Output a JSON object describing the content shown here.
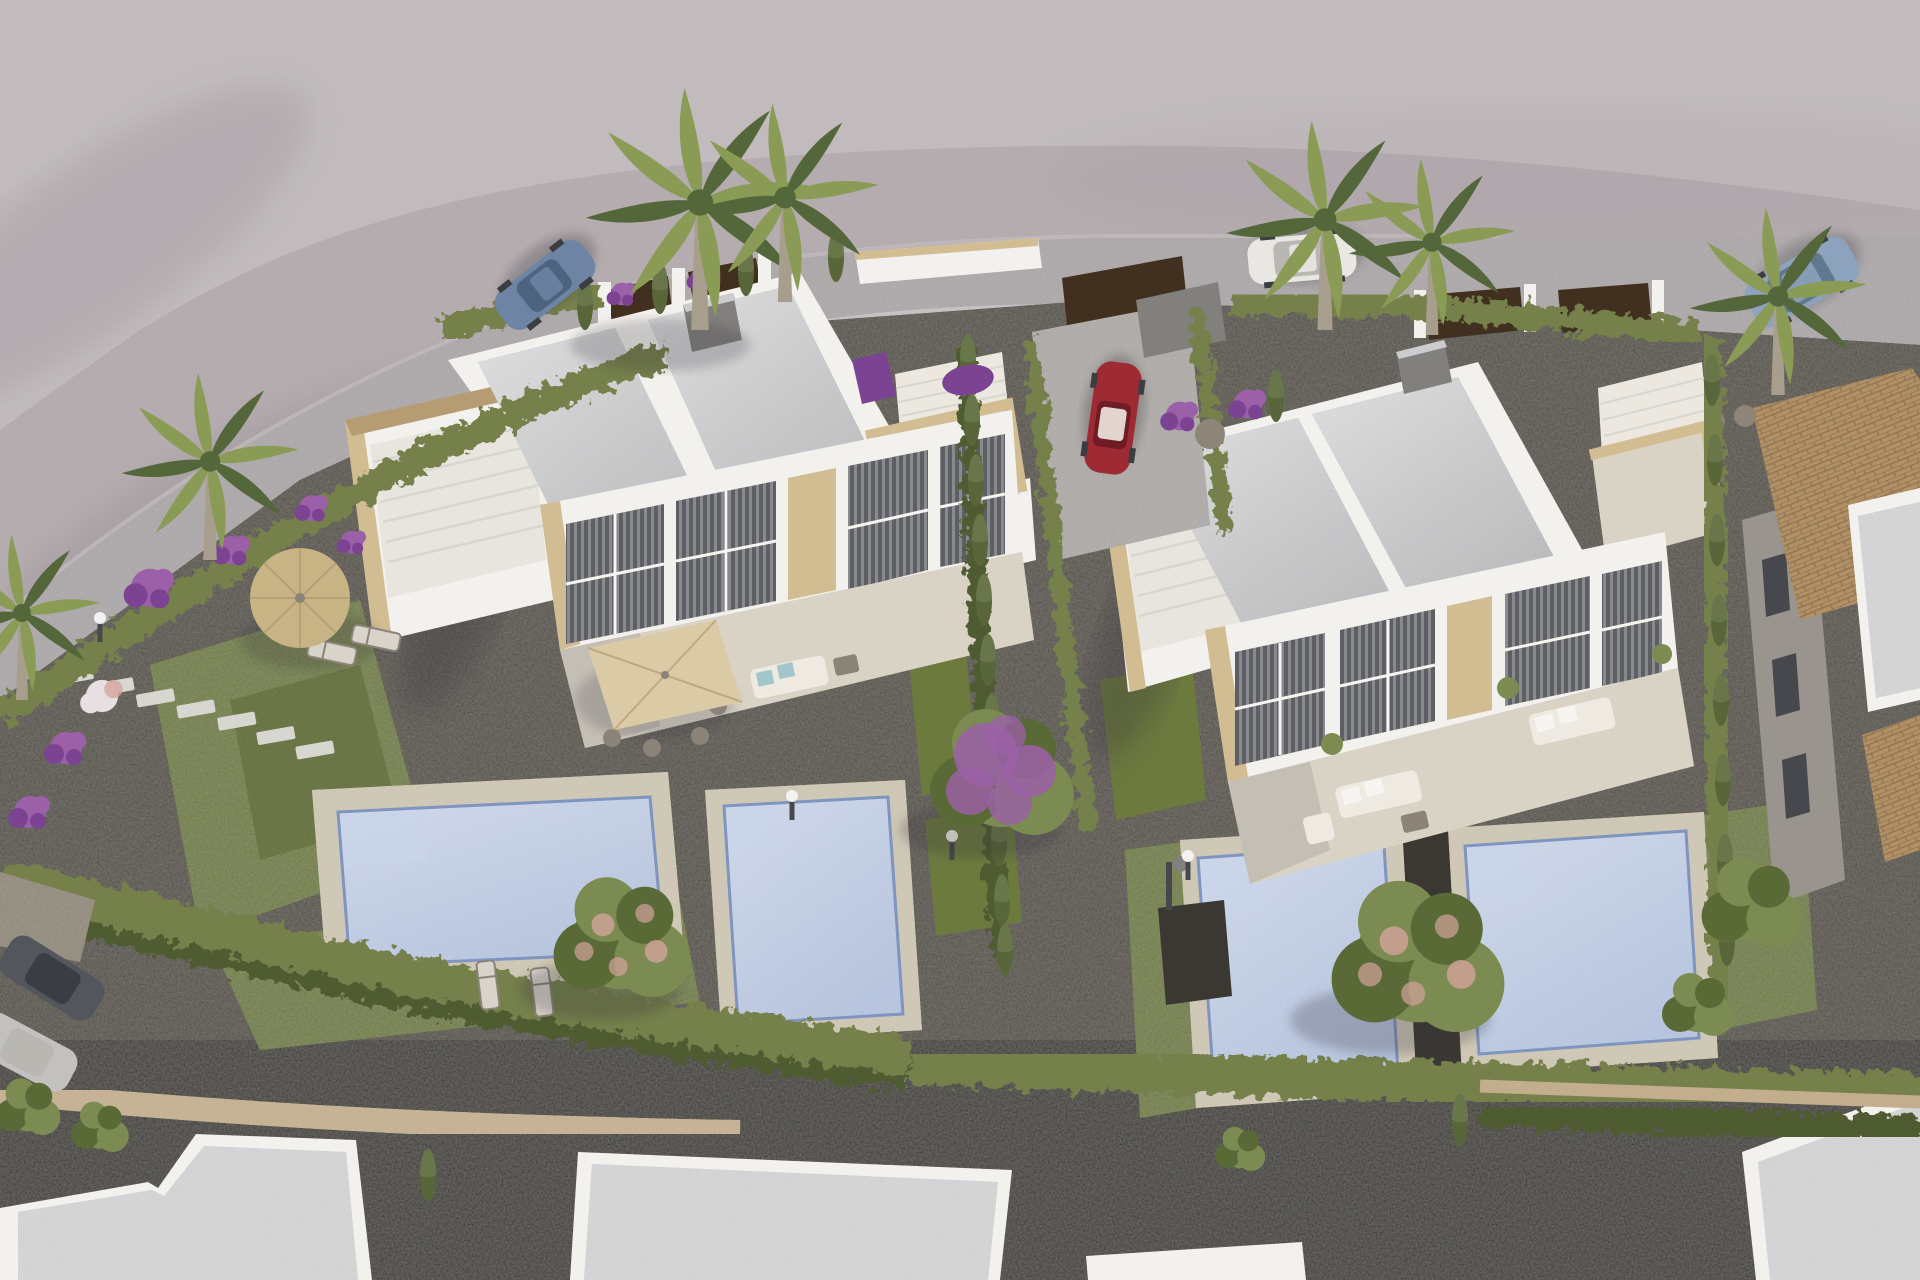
{
  "scene": {
    "type": "3d-architectural-aerial-render",
    "view": "high-angle aerial perspective",
    "setting": "New-build development of modern white semi-detached villas with flat gravel roofs, private pools, landscaped gardens, cypress hedges, palm trees and parked cars",
    "lighting": "warm late-afternoon sun from upper right, soft shadows toward lower left"
  },
  "inventory": {
    "villas": 2,
    "dwelling_units": 4,
    "pools": 4,
    "cars": 6,
    "palm_trees": 6,
    "parasols": 2,
    "neighbor_buildings": 5
  },
  "labels": {
    "ground": "Bare graded ground",
    "road": "Curved access road",
    "leftVilla": "Left semi-detached villa pair",
    "leftRoof": "Left villa gravel flat roofs",
    "leftSolarium": "Left villa roof solarium with stone parapet",
    "leftStairs": "Left villa external staircase terrace",
    "leftFacade": "Left villa glazed facade with blinds",
    "leftTerrace": "Left villa ground terrace",
    "leftGarden": "Left lawn garden with straw parasol",
    "mainPool": "Main private pool",
    "secondPool": "Second private pool",
    "rightVilla": "Right semi-detached villa pair",
    "rightRoof": "Right villa gravel flat roofs",
    "rightSolarium": "Right villa roof solarium",
    "rightStairs": "Right villa external staircase",
    "rightFacade": "Right villa glazed facade",
    "rightTerrace": "Right villa ground terrace",
    "poolC": "Right villa pool (left unit)",
    "poolD": "Right villa pool (right unit)",
    "driveway": "Shared driveway with parked red car",
    "garage": "Garage door",
    "redCar": "Red convertible in driveway",
    "sportsCar": "Blue sports car on road",
    "whiteCar": "White sedan parked on road",
    "suv": "Light blue SUV parked on road",
    "streetCars": "Cars parked on lower street",
    "palms": "Fan palm trees",
    "bougainvillea": "Purple bougainvillea tree",
    "blossomTrees": "Blossoming garden trees",
    "hedges": "Clipped boundary hedges",
    "boundaryWall": "White boundary wall with stone caps and timber gates",
    "neighborHouse": "Neighbouring house with terracotta tiled roof",
    "neighborRoofs": "Unfinished white neighbour rooftops",
    "gravel": "Dark decorative gravel",
    "steppingStones": "Stepping stone path",
    "strawParasol": "Straw parasol with loungers",
    "diningParasol": "Cream patio parasol with dining set",
    "sofas": "Outdoor lounge furniture",
    "lamps": "Garden bollard lights",
    "shower": "Outdoor pool shower",
    "flowerBeds": "Purple and white flowering shrubs",
    "stoneWall": "Stone retaining wall",
    "sandPath": "Sand-coloured footpath"
  },
  "palette": {
    "bg": "#b4acaf",
    "bgLight": "#c6c0c1",
    "bgShadow": "#9b939a",
    "shadow": "#35333a",
    "road": "#a8a3a5",
    "roadEdge": "#c6c2c3",
    "conc": "#aaa6a4",
    "gravel": "#524d46",
    "gravelDark": "#3b3833",
    "sand": "#c2ad8d",
    "stoneGrey": "#8d8577",
    "wallWhite": "#f3f1ed",
    "wallShade": "#d8d6d1",
    "wallBright": "#fbfaf7",
    "roof": "#b7b8ba",
    "roofLight": "#ccccce",
    "roofShade": "#9a9b9e",
    "stone": "#d2bc92",
    "stoneDark": "#b59c72",
    "tileLine": "#8a6f4e",
    "terracotta": "#b29066",
    "glass": "#5d5f64",
    "glassDark": "#46484e",
    "terrace": "#d7d0c2",
    "deck": "#ccc4b1",
    "pool": "#a9bad9",
    "poolLight": "#c9d4ea",
    "poolDark": "#7f95bf",
    "grass": "#6d7a3e",
    "grassDark": "#566330",
    "hedge": "#75804b",
    "hedgeDark": "#4f5c31",
    "cypress": "#68764a",
    "treeGreen": "#7b8b51",
    "treeDark": "#596a37",
    "palmGreen": "#8a9b55",
    "palmDark": "#54673a",
    "palmTrunk": "#a89e8d",
    "purple": "#9c60a8",
    "purpleDark": "#7b4392",
    "pinkBloom": "#d4a49c",
    "whiteBloom": "#e8dfe2",
    "parasol": "#dbcaa6",
    "straw": "#c7b383",
    "chimney": "#82807d",
    "brown": "#41301f",
    "carRed": "#9e2b33",
    "carRedDark": "#6f1c24",
    "carBlue": "#6d84a4",
    "carBlueDark": "#4e6380",
    "carWhite": "#e9e7e2",
    "carWhiteDark": "#b9b7b2",
    "carSuv": "#8da3bd",
    "carSuvDark": "#61788f",
    "carDark": "#53565c",
    "carDarkDark": "#3a3d42",
    "carSilver": "#c2c1bf",
    "furn": "#8b8378",
    "cushion": "#eeeae2",
    "teal": "#a3c6cb",
    "white": "#f6f5f2"
  }
}
